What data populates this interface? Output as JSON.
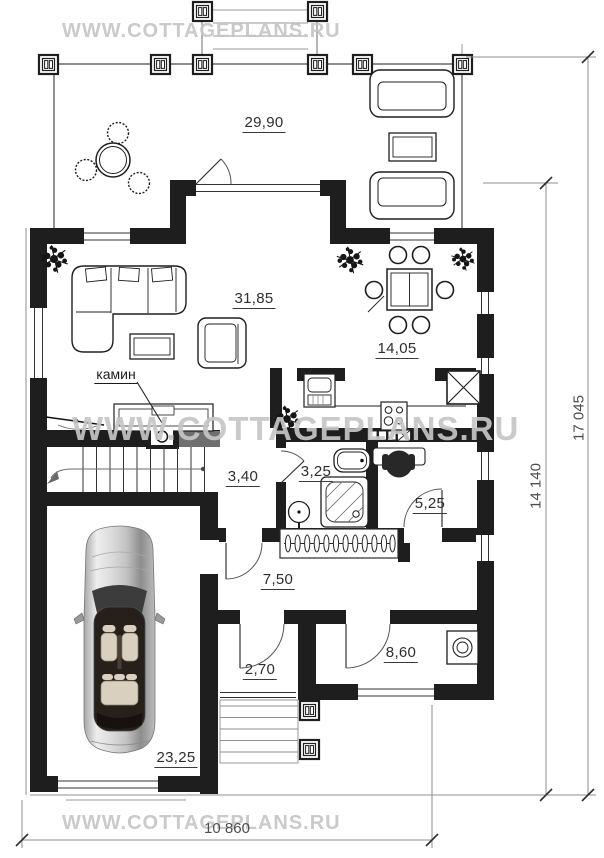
{
  "watermark": {
    "text": "WWW.COTTAGEPLANS.RU"
  },
  "rooms": [
    {
      "key": "terrace",
      "area": "29,90"
    },
    {
      "key": "living",
      "area": "31,85"
    },
    {
      "key": "dining",
      "area": "14,05"
    },
    {
      "key": "hall",
      "area": "3,40"
    },
    {
      "key": "bathroom",
      "area": "3,25"
    },
    {
      "key": "pantry",
      "area": "5,25"
    },
    {
      "key": "corridor",
      "area": "7,50"
    },
    {
      "key": "vestibule",
      "area": "2,70"
    },
    {
      "key": "boiler",
      "area": "8,60"
    },
    {
      "key": "garage",
      "area": "23,25"
    }
  ],
  "annotations": {
    "fireplace_label": "камин"
  },
  "dimensions": {
    "overall_depth": "17 045",
    "house_depth": "14 140",
    "overall_width": "10 860"
  },
  "colors": {
    "wall": "#1e1e1e",
    "watermark": "#c6c6c6",
    "dimension_line": "#8f8f8f",
    "label_text": "#2e2e2e"
  }
}
